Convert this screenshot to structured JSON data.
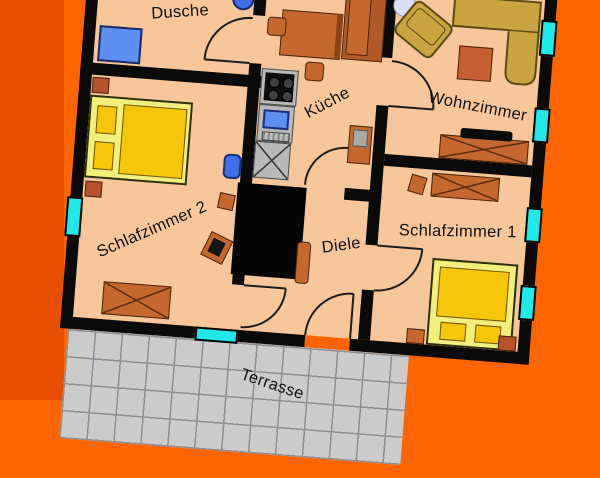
{
  "rooms": {
    "dusche": {
      "label": "Dusche"
    },
    "kueche": {
      "label": "Küche"
    },
    "wohnzimmer": {
      "label": "Wohnzimmer"
    },
    "schlafzimmer1": {
      "label": "Schlafzimmer 1"
    },
    "schlafzimmer2": {
      "label": "Schlafzimmer 2"
    },
    "diele": {
      "label": "Diele"
    },
    "terrasse": {
      "label": "Terrasse"
    }
  },
  "colors": {
    "background": "#FF6400",
    "left_band": "#E84E00",
    "floor": "#F7C79B",
    "wall": "#0A0A0A",
    "window": "#1FE9E9",
    "furniture": "#C4682F",
    "furniture_border": "#4A2408",
    "rust": "#B5532C",
    "sofa": "#C9A440",
    "sofa_border": "#5C4A14",
    "bed_frame": "#F3EF7D",
    "bed_gold": "#F6C60A",
    "fixture_blue": "#5D8FF0",
    "toilet_blue": "#3E6FE8",
    "appliance_gray": "#B9B9B9",
    "terrace": "#CBCBCB",
    "terrace_line": "#8F8F8F",
    "label_color": "#111111"
  }
}
